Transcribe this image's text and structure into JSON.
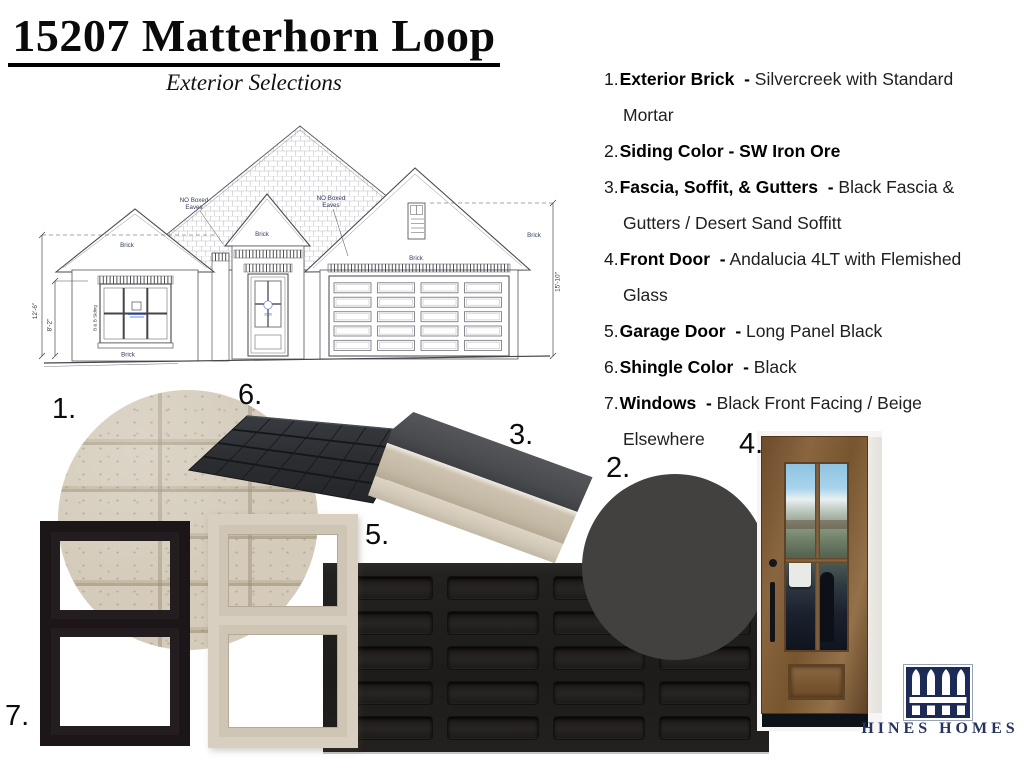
{
  "header": {
    "title": "15207 Matterhorn Loop",
    "subtitle": "Exterior Selections"
  },
  "selections": [
    {
      "num": "1.",
      "label": "Exterior Brick  -",
      "value": " Silvercreek with Standard Mortar"
    },
    {
      "num": "2.",
      "label": "Siding Color - SW Iron Ore",
      "value": ""
    },
    {
      "num": "3.",
      "label": "Fascia, Soffit, & Gutters  -",
      "value": " Black Fascia & Gutters / Desert Sand Soffitt"
    },
    {
      "num": "4.",
      "label": "Front Door  -",
      "value": " Andalucia 4LT with Flemished Glass"
    },
    {
      "num": "5.",
      "label": "Garage Door  -",
      "value": " Long Panel Black"
    },
    {
      "num": "6.",
      "label": "Shingle Color  -",
      "value": " Black"
    },
    {
      "num": "7.",
      "label": "Windows  -",
      "value": " Black Front Facing / Beige Elsewhere"
    }
  ],
  "samples": {
    "brick": {
      "label": "1."
    },
    "paint": {
      "label": "2.",
      "color": "#434140"
    },
    "gutter": {
      "label": "3."
    },
    "door": {
      "label": "4."
    },
    "garage": {
      "label": "5.",
      "color": "#221f1e"
    },
    "shingle": {
      "label": "6."
    },
    "windows": {
      "label": "7."
    }
  },
  "drawing": {
    "no_boxed_line1": "NO Boxed",
    "no_boxed_line2": "Eaves",
    "brick": "Brick",
    "bb_siding": "B & B Siding",
    "dim_left_outer": "12'-6\"",
    "dim_left_inner": "8'-2\"",
    "dim_right": "15'-10\"",
    "door_size": "3080"
  },
  "logo": {
    "text": "HINES HOMES",
    "navy": "#1c2a56"
  },
  "colors": {
    "brick_base": "#d2c9b8",
    "brick_mortar": "#b2a791",
    "shingle_black": "#2b2d31",
    "fascia_gray": "#4b4c4e",
    "soffit_sand": "#c6bba8",
    "iron_ore": "#434140",
    "garage_black": "#221f1e",
    "window_black": "#1d1619",
    "window_beige": "#d8cfc1",
    "logo_navy": "#1c2a56"
  }
}
